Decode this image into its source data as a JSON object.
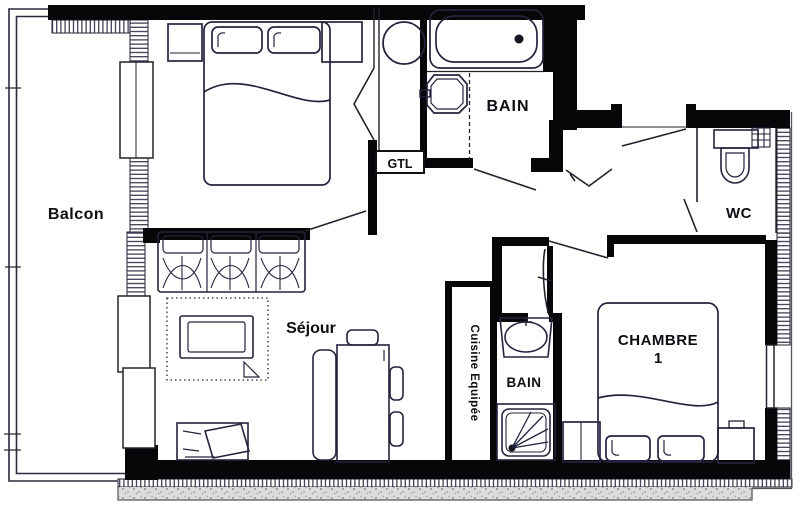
{
  "floor_plan": {
    "type": "apartment-floor-plan-scan",
    "labels": {
      "balcony": "Balcon",
      "bathroom_top": "BAIN",
      "wc": "WC",
      "technical_duct": "GTL",
      "living_room": "Séjour",
      "kitchen": "Cuisine Equipée",
      "bathroom_bottom": "BAIN",
      "bedroom1_line1": "CHAMBRE",
      "bedroom1_line2": "1"
    },
    "colors": {
      "wall": "#070709",
      "ink": "#23233d",
      "paper": "#ffffff",
      "concrete_band": "#d9d9d9",
      "hatch": "#2a2a3a"
    }
  }
}
